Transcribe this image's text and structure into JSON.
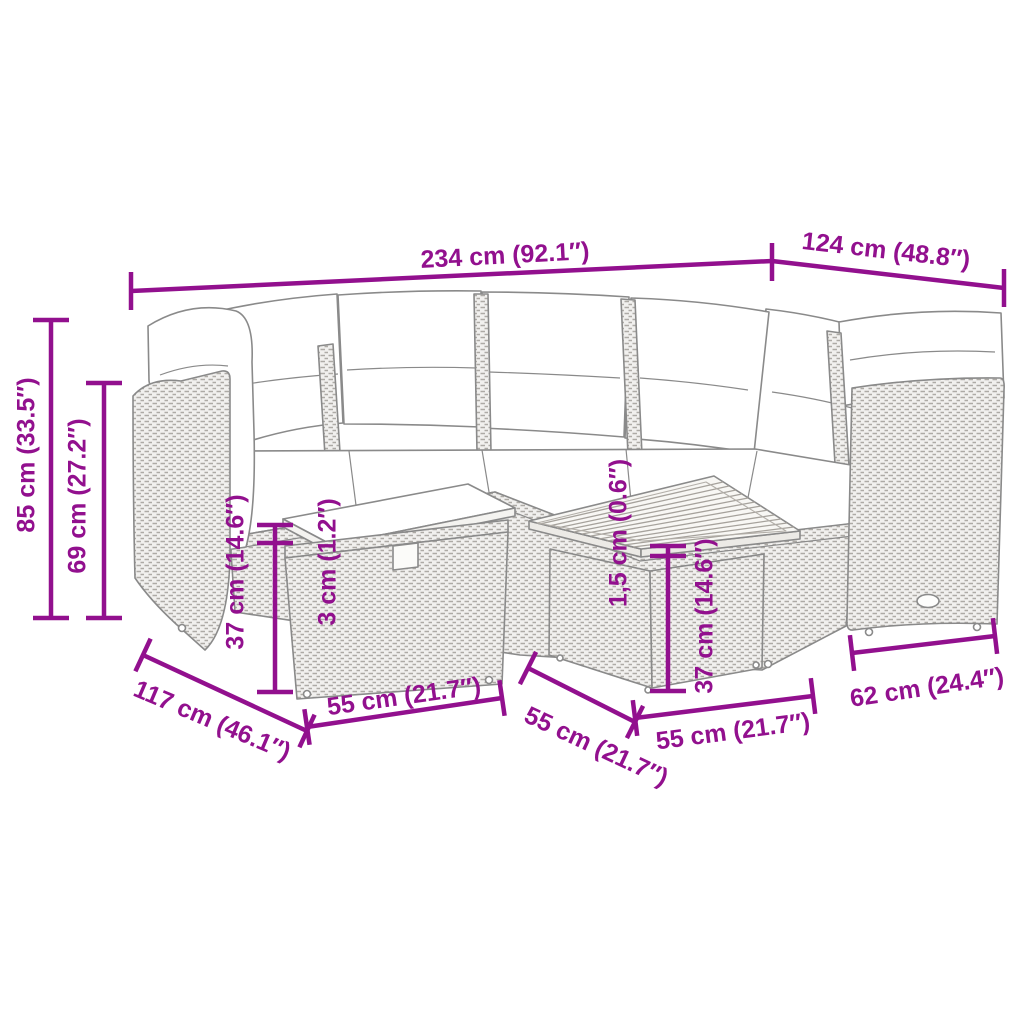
{
  "diagram": {
    "type": "furniture-dimension-diagram",
    "illustration": "rattan garden corner sofa set with cushions, ottoman and slatted-top coffee table (line drawing)",
    "colors": {
      "dimension_accent": "#92108e",
      "line_art": "#8f8f8f",
      "background": "#ffffff"
    },
    "dimensions": {
      "sofa_total_width": "234 cm (92.1″)",
      "sofa_right_width": "124 cm (48.8″)",
      "sofa_total_height": "85 cm (33.5″)",
      "sofa_back_height": "69 cm (27.2″)",
      "ottoman_height": "37 cm (14.6″)",
      "ottoman_cushion_thickness": "3 cm (1.2″)",
      "table_top_thickness": "1,5 cm (0.6″)",
      "table_height": "37 cm (14.6″)",
      "sofa_depth": "117 cm (46.1″)",
      "ottoman_width": "55 cm (21.7″)",
      "table_depth": "55 cm (21.7″)",
      "table_width": "55 cm (21.7″)",
      "right_section_depth": "62 cm (24.4″)"
    }
  }
}
